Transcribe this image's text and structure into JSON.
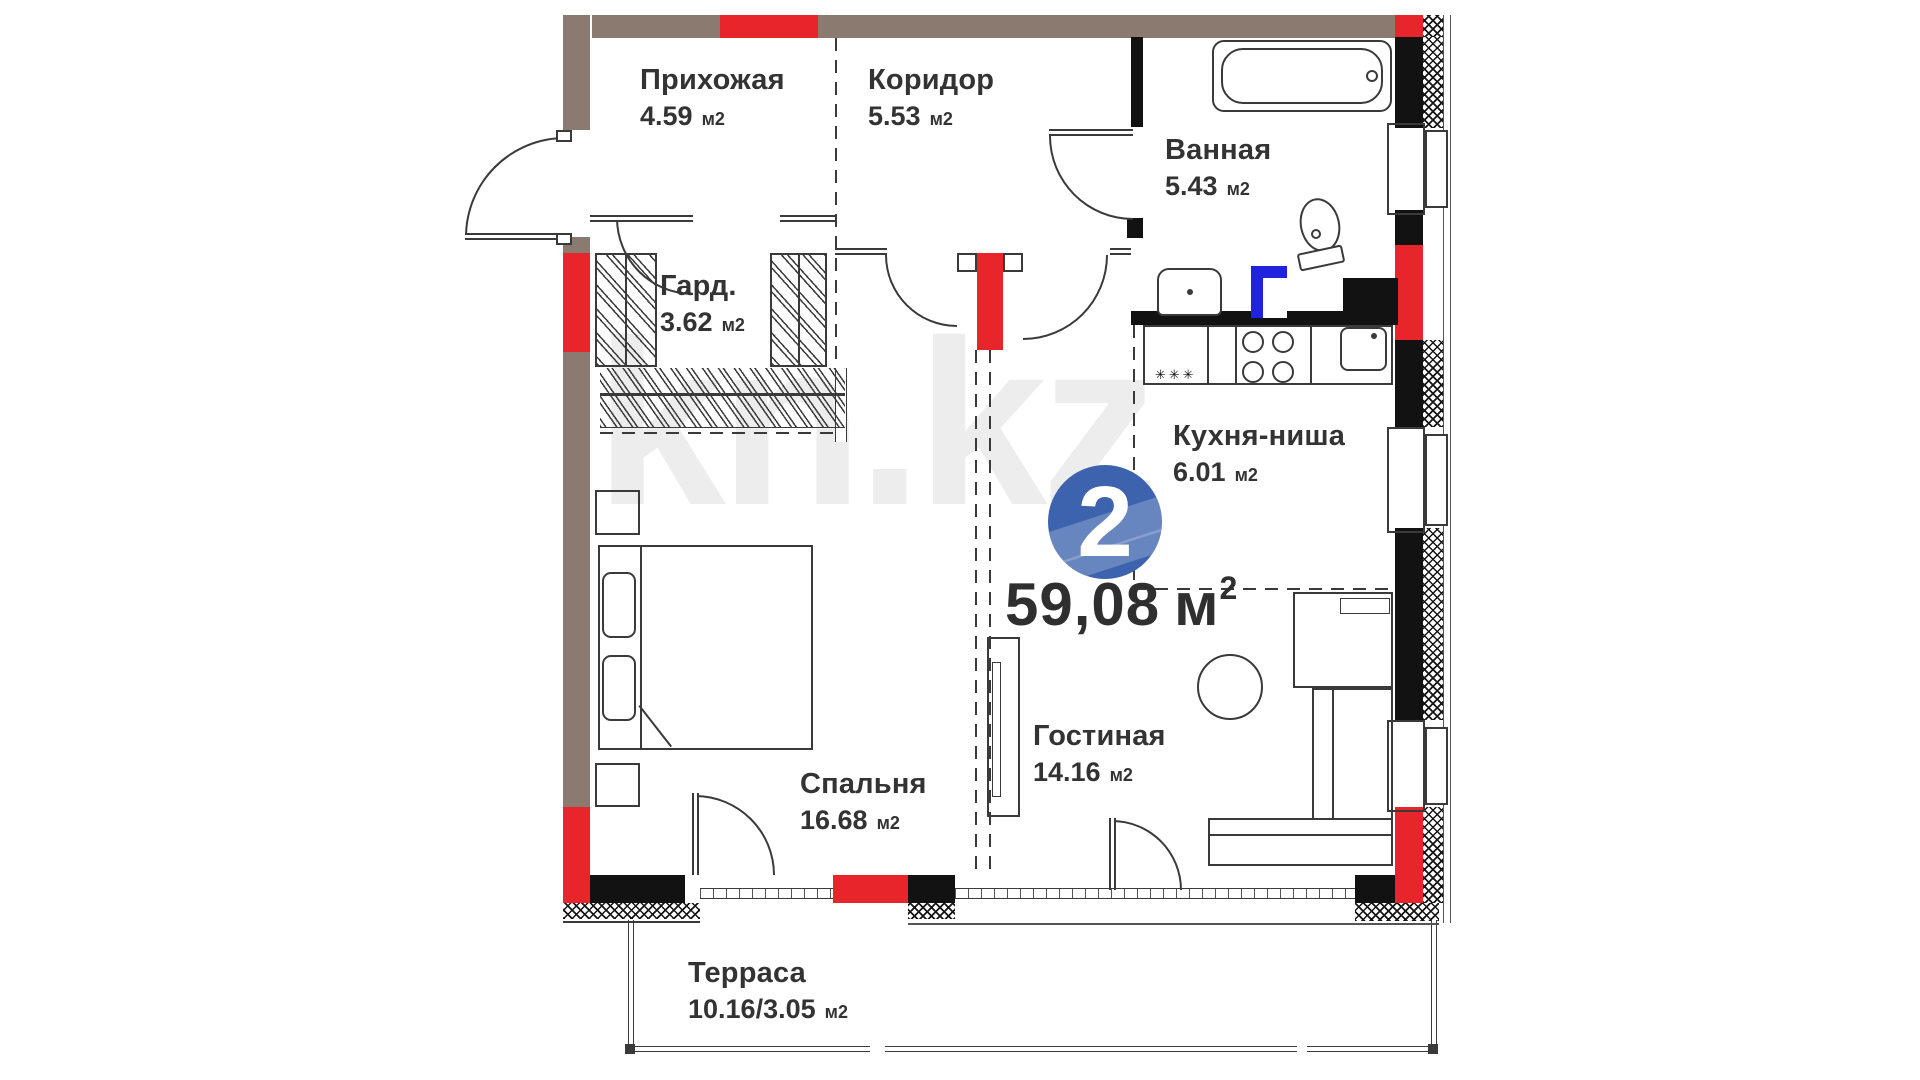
{
  "colors": {
    "wall_brown": "#8b7a70",
    "wall_red": "#e8252a",
    "wall_black": "#121212",
    "pipe_blue": "#1f24dc",
    "badge_blue": "#3d63ae",
    "line": "#3a3a3a",
    "text": "#333333",
    "watermark": "#ededed"
  },
  "badge": {
    "number": "2"
  },
  "total_area": {
    "value": "59,08",
    "unit": "м",
    "sup": "2"
  },
  "watermark_text": "kn.kz",
  "kitchen_marks": "✳✳✳",
  "rooms": {
    "hallway": {
      "name": "Прихожая",
      "area": "4.59",
      "unit": "м2"
    },
    "corridor": {
      "name": "Коридор",
      "area": "5.53",
      "unit": "м2"
    },
    "bathroom": {
      "name": "Ванная",
      "area": "5.43",
      "unit": "м2"
    },
    "wardrobe": {
      "name": "Гард.",
      "area": "3.62",
      "unit": "м2"
    },
    "kitchen": {
      "name": "Кухня-ниша",
      "area": "6.01",
      "unit": "м2"
    },
    "bedroom": {
      "name": "Спальня",
      "area": "16.68",
      "unit": "м2"
    },
    "living": {
      "name": "Гостиная",
      "area": "14.16",
      "unit": "м2"
    },
    "terrace": {
      "name": "Терраса",
      "area": "10.16/3.05",
      "unit": "м2"
    }
  }
}
